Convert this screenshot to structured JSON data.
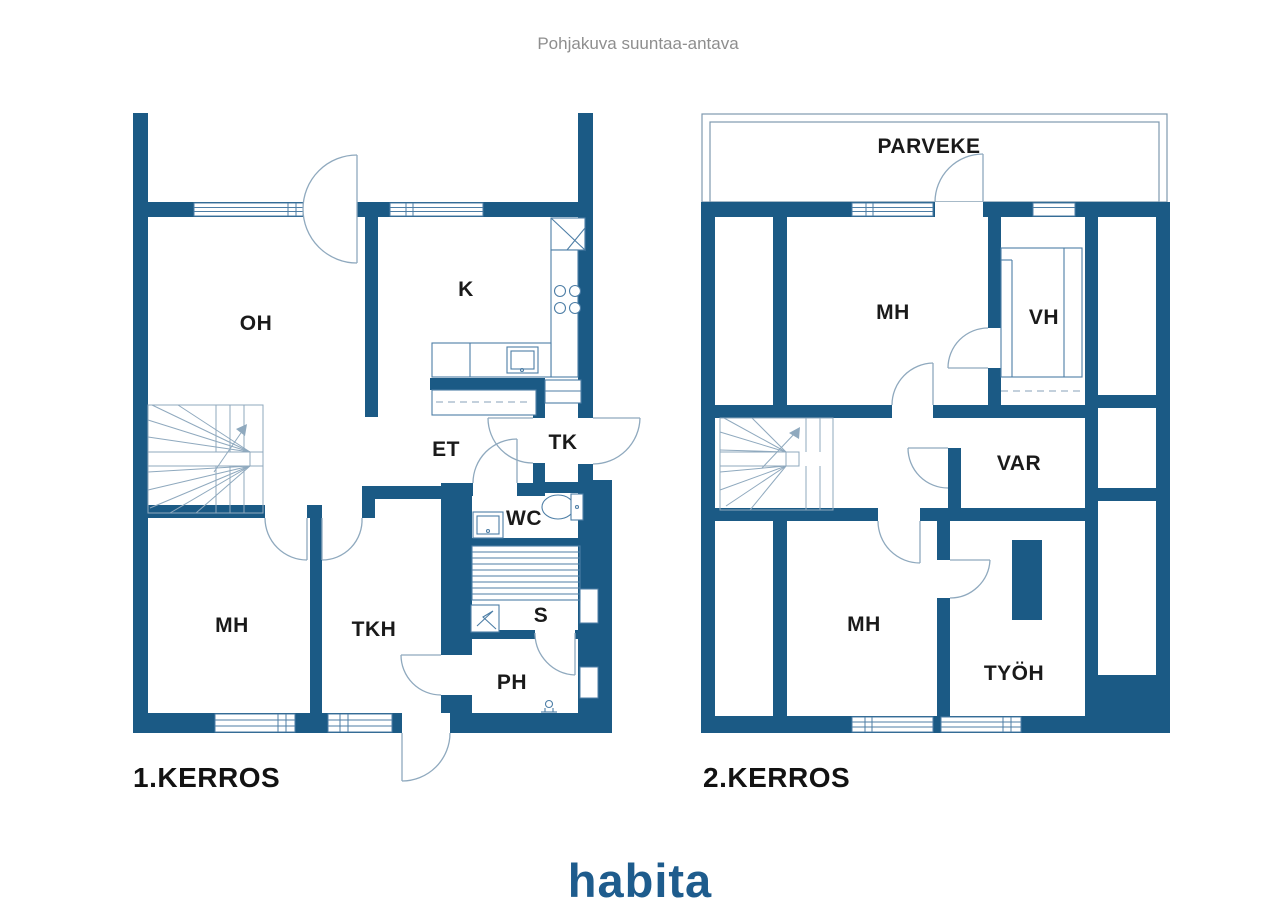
{
  "title": "Pohjakuva suuntaa-antava",
  "logo_text": "habita",
  "colors": {
    "wall_blue": "#1b5a85",
    "thin_line": "#8fa9be",
    "frame_line": "#4d7ea6",
    "label_black": "#1a1a1a",
    "title_gray": "#8e8e8e",
    "logo_blue": "#1e5c8d"
  },
  "floor1": {
    "name": "1.KERROS",
    "rooms": {
      "oh": "OH",
      "k": "K",
      "et": "ET",
      "tk": "TK",
      "wc": "WC",
      "sauna": "S",
      "ph": "PH",
      "mh": "MH",
      "tkh": "TKH"
    }
  },
  "floor2": {
    "name": "2.KERROS",
    "balcony_label": "PARVEKE",
    "rooms": {
      "mh_top": "MH",
      "vh": "VH",
      "var": "VAR",
      "mh_bottom": "MH",
      "tyoh": "TYÖH"
    }
  }
}
